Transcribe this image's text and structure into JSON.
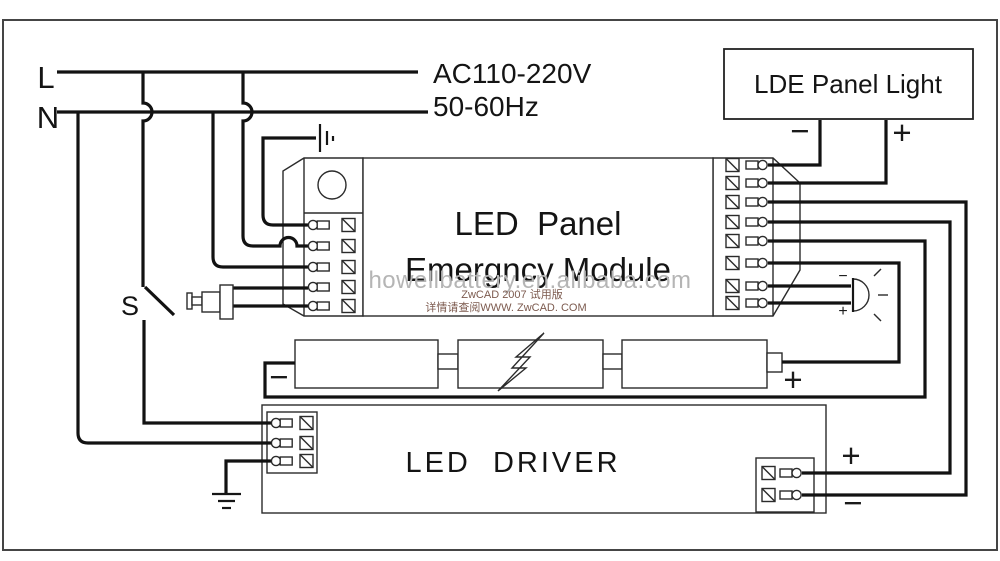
{
  "title": "LED Panel Emergency Module wiring diagram",
  "colors": {
    "background": "#ffffff",
    "wire": "#121212",
    "outline": "#2b2b2b",
    "border": "#454545",
    "watermark": "#b5b5b5",
    "cad_stamp": "#7c5a4e"
  },
  "labels": {
    "live": "L",
    "neutral": "N",
    "voltage": "AC110-220V",
    "frequency": "50-60Hz",
    "switch": "S",
    "panel_light": "LDE Panel Light",
    "module_line1": "LED  Panel",
    "module_line2": "Emergncy Module",
    "driver": "LED  DRIVER",
    "watermark": "howellbattery.en.alibaba.com",
    "cad_stamp_line1": "ZwCAD 2007 试用版",
    "cad_stamp_line2": "详情请查阅WWW. ZwCAD. COM",
    "plus": "+",
    "minus": "−"
  }
}
